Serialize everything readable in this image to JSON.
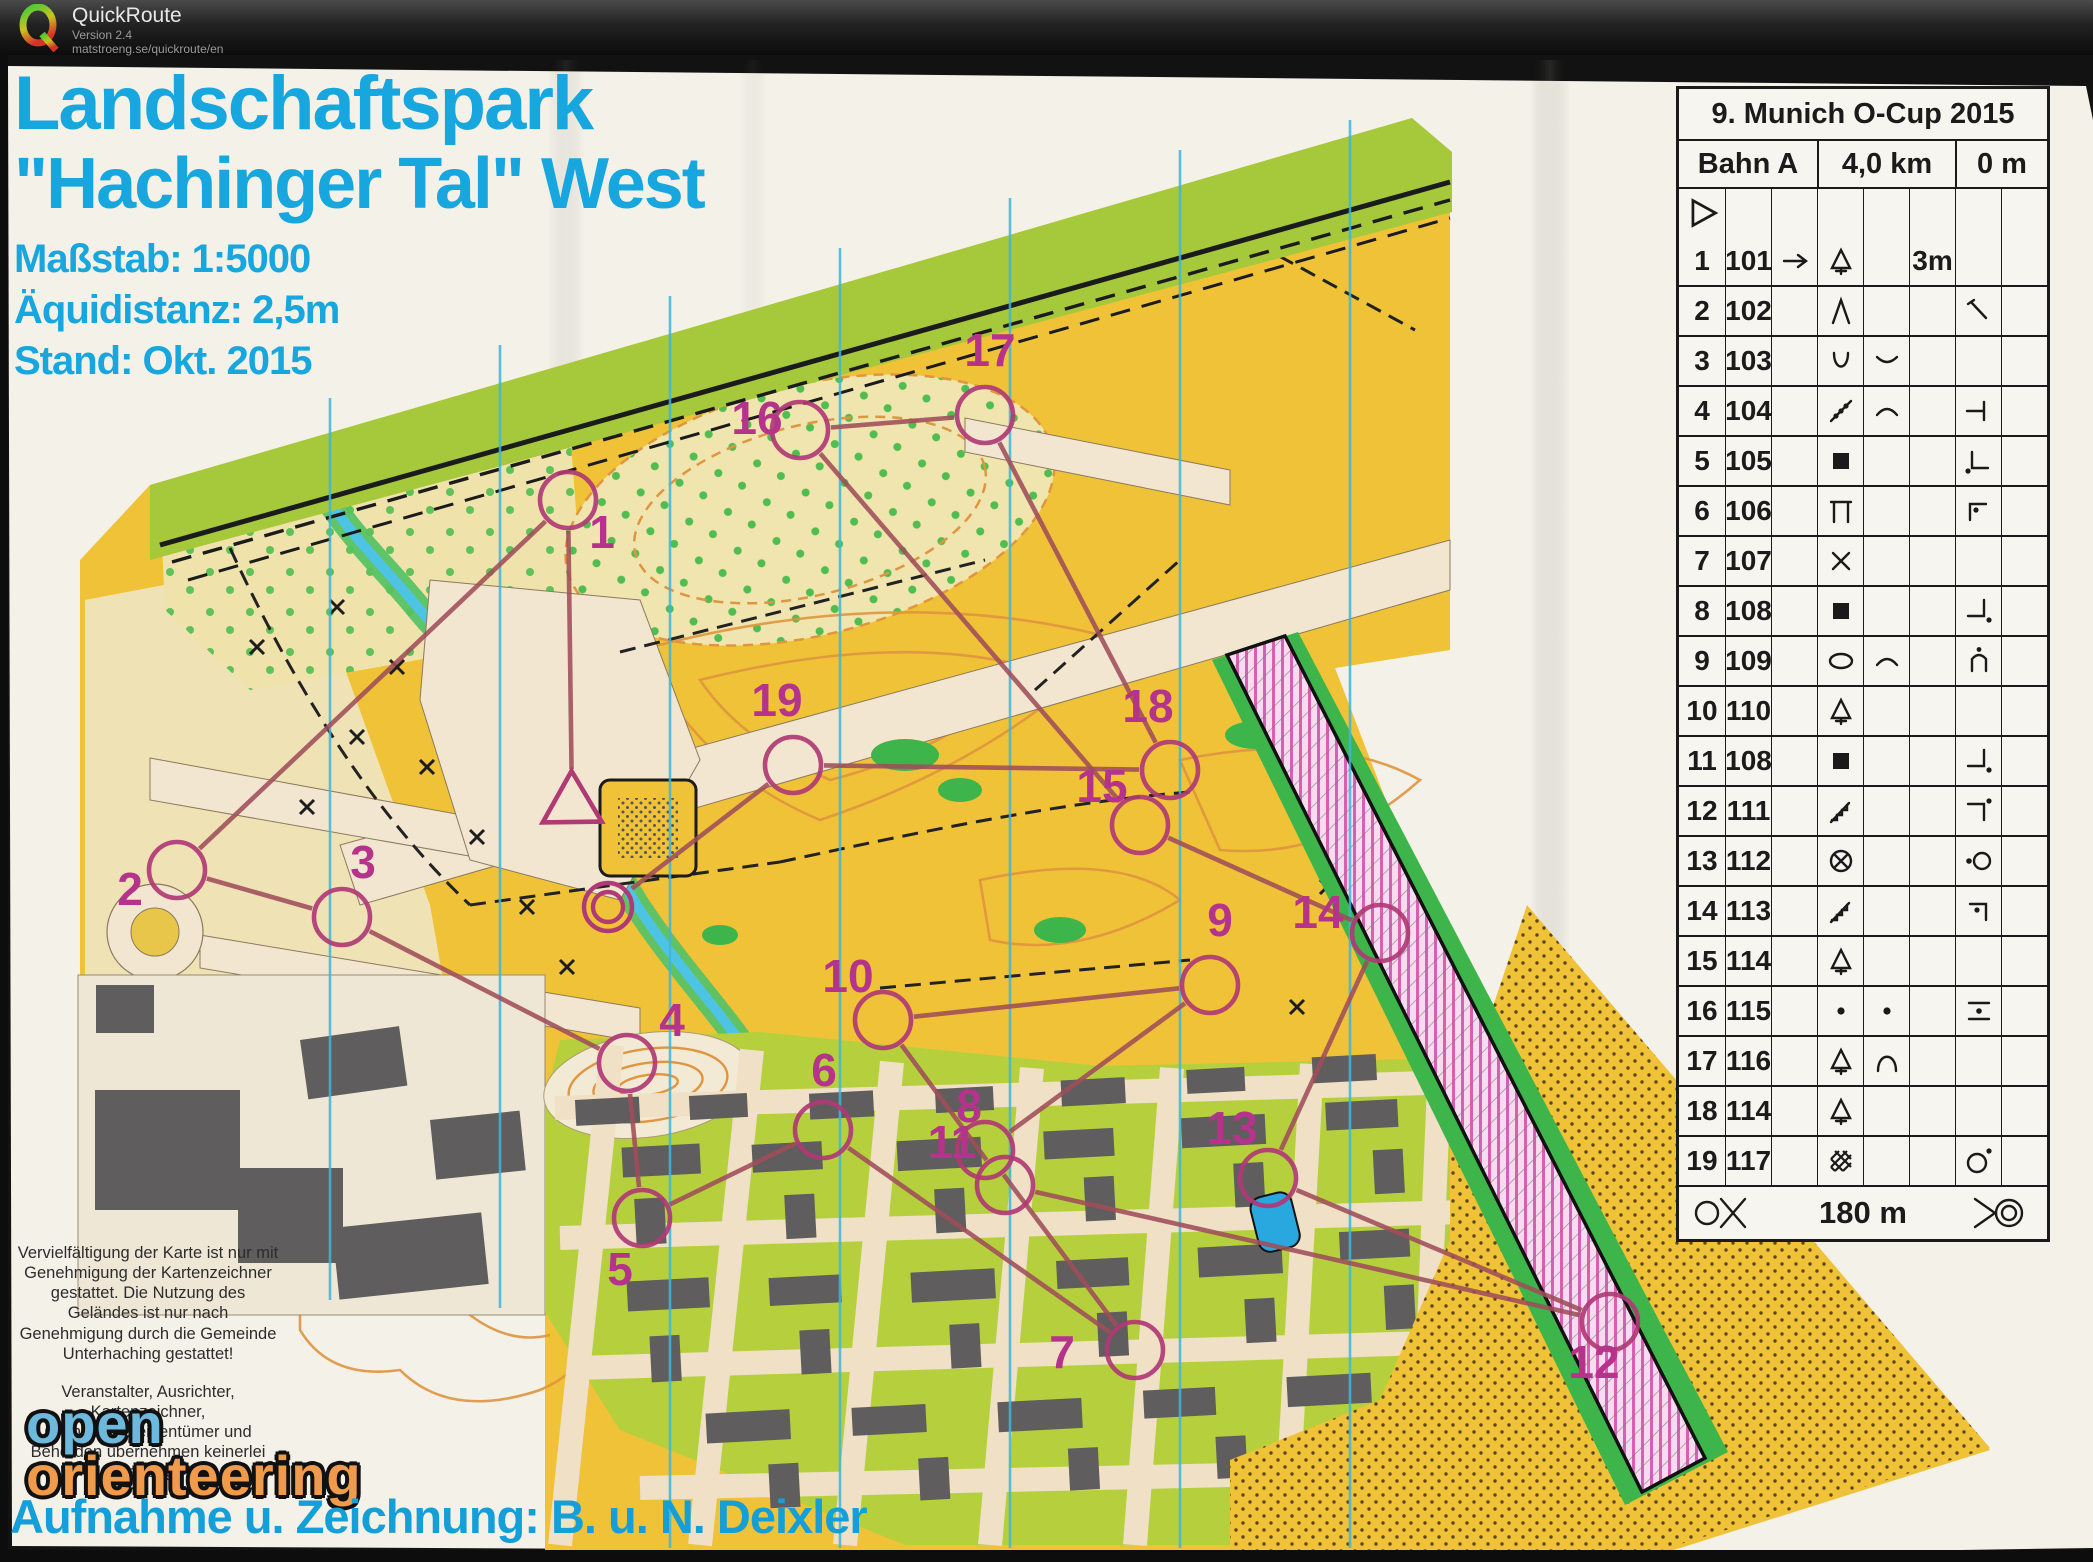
{
  "window": {
    "app_title": "QuickRoute",
    "version": "Version 2.4",
    "url": "matstroeng.se/quickroute/en"
  },
  "map": {
    "title_line1": "Landschaftspark",
    "title_line2": "\"Hachinger Tal\" West",
    "scale_label": "Maßstab: 1:5000",
    "equidistance_label": "Äquidistanz: 2,5m",
    "status_label": "Stand: Okt. 2015",
    "disclaimer_1": "Vervielfältigung der Karte ist nur mit Genehmigung der Kartenzeichner gestattet. Die Nutzung des Geländes ist nur nach Genehmigung durch die Gemeinde Unterhaching gestattet!",
    "disclaimer_2": "Veranstalter, Ausrichter, Kartenzeichner, Grundstückseigentümer und Behörden übernehmen keinerlei Haftung!",
    "logo_word_1": "open",
    "logo_word_2": "orienteering",
    "credit": "Aufnahme u. Zeichnung: B. u. N. Deixler",
    "colors": {
      "title_cyan": "#17a7de",
      "open_yellow": "#f0c237",
      "pale_yellow": "#f0e5ae",
      "band_green": "#a6c83b",
      "yard_green": "#b5d03c",
      "building_gray": "#5f5d5d",
      "north_line_cyan": "#3fb6da",
      "course_purple": "#b03a75",
      "out_of_bounds_pink": "#d95fb2"
    }
  },
  "control_card": {
    "title": "9. Munich O-Cup 2015",
    "course_name": "Bahn A",
    "length": "4,0 km",
    "climb": "0 m",
    "finish_distance": "180 m",
    "rows": [
      {
        "n": "1",
        "code": "101",
        "c": "arrow-right",
        "d": "tree",
        "e": "",
        "f": "3m",
        "g": "",
        "h": ""
      },
      {
        "n": "2",
        "code": "102",
        "c": "",
        "d": "spike",
        "e": "",
        "f": "",
        "g": "junction",
        "h": ""
      },
      {
        "n": "3",
        "code": "103",
        "c": "",
        "d": "u-shape",
        "e": "arc-dn",
        "f": "",
        "g": "",
        "h": ""
      },
      {
        "n": "4",
        "code": "104",
        "c": "",
        "d": "veg-line",
        "e": "arc-up",
        "f": "",
        "g": "tbar",
        "h": ""
      },
      {
        "n": "5",
        "code": "105",
        "c": "",
        "d": "building",
        "e": "",
        "f": "",
        "g": "corner-sw-dot",
        "h": ""
      },
      {
        "n": "6",
        "code": "106",
        "c": "",
        "d": "canopy",
        "e": "",
        "f": "",
        "g": "corner-nw-dot",
        "h": ""
      },
      {
        "n": "7",
        "code": "107",
        "c": "",
        "d": "cross",
        "e": "",
        "f": "",
        "g": "",
        "h": ""
      },
      {
        "n": "8",
        "code": "108",
        "c": "",
        "d": "building",
        "e": "",
        "f": "",
        "g": "corner-se-dot",
        "h": ""
      },
      {
        "n": "9",
        "code": "109",
        "c": "",
        "d": "copse",
        "e": "arc-up",
        "f": "",
        "g": "n-dot",
        "h": ""
      },
      {
        "n": "10",
        "code": "110",
        "c": "",
        "d": "tree",
        "e": "",
        "f": "",
        "g": "",
        "h": ""
      },
      {
        "n": "11",
        "code": "108",
        "c": "",
        "d": "building",
        "e": "",
        "f": "",
        "g": "corner-se-dot",
        "h": ""
      },
      {
        "n": "12",
        "code": "111",
        "c": "",
        "d": "stairs",
        "e": "",
        "f": "",
        "g": "corner-ne-dot",
        "h": ""
      },
      {
        "n": "13",
        "code": "112",
        "c": "",
        "d": "special",
        "e": "",
        "f": "",
        "g": "dot-circle",
        "h": ""
      },
      {
        "n": "14",
        "code": "113",
        "c": "",
        "d": "stairs",
        "e": "",
        "f": "",
        "g": "corner-nw-dot2",
        "h": ""
      },
      {
        "n": "15",
        "code": "114",
        "c": "",
        "d": "tree",
        "e": "",
        "f": "",
        "g": "",
        "h": ""
      },
      {
        "n": "16",
        "code": "115",
        "c": "",
        "d": "dot",
        "e": "dot",
        "f": "",
        "g": "between",
        "h": ""
      },
      {
        "n": "17",
        "code": "116",
        "c": "",
        "d": "tree",
        "e": "knoll",
        "f": "",
        "g": "",
        "h": ""
      },
      {
        "n": "18",
        "code": "114",
        "c": "",
        "d": "tree",
        "e": "",
        "f": "",
        "g": "",
        "h": ""
      },
      {
        "n": "19",
        "code": "117",
        "c": "",
        "d": "thicket",
        "e": "",
        "f": "",
        "g": "circle-dot",
        "h": ""
      }
    ]
  },
  "course": {
    "start": {
      "x": 572,
      "y": 805
    },
    "finish": {
      "x": 608,
      "y": 907
    },
    "controls": [
      {
        "n": "1",
        "x": 568,
        "y": 500,
        "lx": 602,
        "ly": 548
      },
      {
        "n": "2",
        "x": 177,
        "y": 870,
        "lx": 130,
        "ly": 905
      },
      {
        "n": "3",
        "x": 342,
        "y": 917,
        "lx": 363,
        "ly": 878
      },
      {
        "n": "4",
        "x": 627,
        "y": 1063,
        "lx": 672,
        "ly": 1036
      },
      {
        "n": "5",
        "x": 642,
        "y": 1218,
        "lx": 620,
        "ly": 1285
      },
      {
        "n": "6",
        "x": 823,
        "y": 1130,
        "lx": 824,
        "ly": 1086
      },
      {
        "n": "7",
        "x": 1135,
        "y": 1350,
        "lx": 1062,
        "ly": 1368
      },
      {
        "n": "8",
        "x": 985,
        "y": 1150,
        "lx": 969,
        "ly": 1122
      },
      {
        "n": "9",
        "x": 1210,
        "y": 985,
        "lx": 1220,
        "ly": 936
      },
      {
        "n": "10",
        "x": 883,
        "y": 1020,
        "lx": 848,
        "ly": 992
      },
      {
        "n": "11",
        "x": 1005,
        "y": 1185,
        "lx": 952,
        "ly": 1158
      },
      {
        "n": "12",
        "x": 1610,
        "y": 1322,
        "lx": 1594,
        "ly": 1378
      },
      {
        "n": "13",
        "x": 1268,
        "y": 1178,
        "lx": 1232,
        "ly": 1144
      },
      {
        "n": "14",
        "x": 1380,
        "y": 933,
        "lx": 1318,
        "ly": 928
      },
      {
        "n": "15",
        "x": 1140,
        "y": 825,
        "lx": 1102,
        "ly": 802
      },
      {
        "n": "16",
        "x": 800,
        "y": 430,
        "lx": 757,
        "ly": 434
      },
      {
        "n": "17",
        "x": 985,
        "y": 415,
        "lx": 990,
        "ly": 366
      },
      {
        "n": "18",
        "x": 1170,
        "y": 770,
        "lx": 1148,
        "ly": 722
      },
      {
        "n": "19",
        "x": 793,
        "y": 765,
        "lx": 777,
        "ly": 716
      }
    ]
  }
}
